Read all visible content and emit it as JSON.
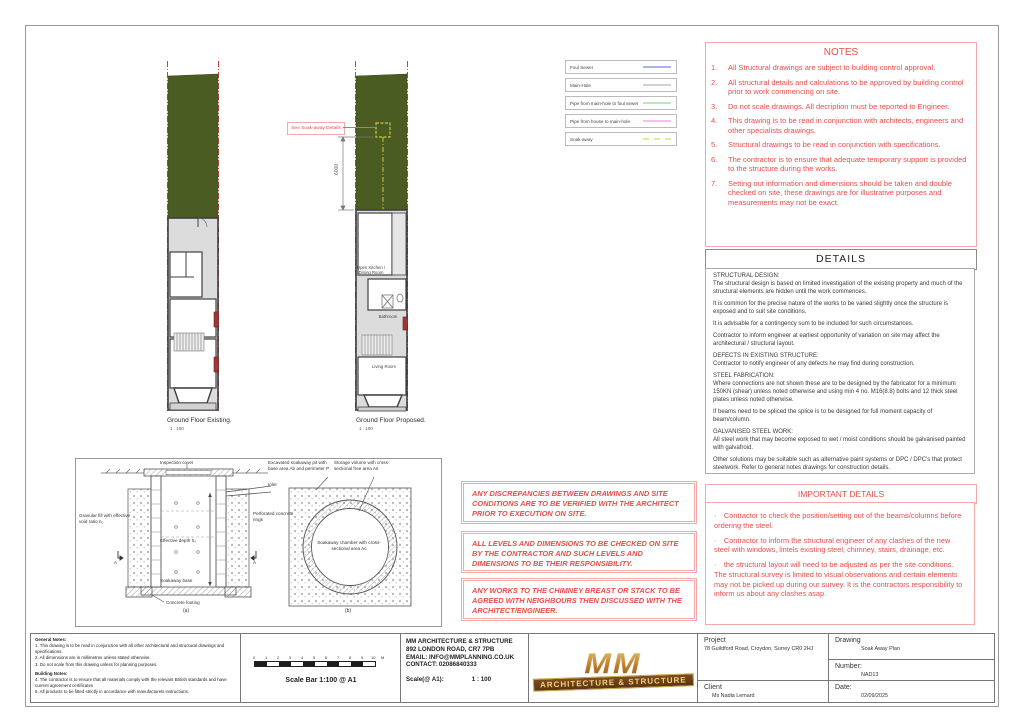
{
  "plans": {
    "existing": {
      "title": "Ground Floor Existing.",
      "scale": "1 : 100"
    },
    "proposed": {
      "title": "Ground Floor Proposed.",
      "scale": "1 : 100",
      "callout": "See Soak-away Details",
      "dimension": "6000",
      "rooms": {
        "kitchen": "Open Kitchen / Dining Room",
        "bathroom": "Bathroom",
        "living": "Living Room"
      }
    }
  },
  "legend": {
    "items": [
      {
        "label": "Foul Sewer",
        "color": "#a9b3ec",
        "line_style": "solid"
      },
      {
        "label": "Main-Hole",
        "color": "#d2d2d2",
        "line_style": "solid"
      },
      {
        "label": "Pipe from main-hole to foul sewer",
        "color": "#b4efb4",
        "line_style": "solid"
      },
      {
        "label": "Pipe from house to main-hole",
        "color": "#f6c0f2",
        "line_style": "solid"
      },
      {
        "label": "Soak-away",
        "color": "#e8e89a",
        "line_style": "dashed"
      }
    ]
  },
  "notes": {
    "title": "NOTES",
    "items": [
      {
        "num": "1.",
        "text": "All Structural drawings are subject to building control approval."
      },
      {
        "num": "2.",
        "text": "All structural details and calculations to be approved by building control prior to work commencing on site."
      },
      {
        "num": "3.",
        "text": "Do not scale drawings. All decription must be reported to Engineer."
      },
      {
        "num": "4.",
        "text": "This drawing is to be read in conjunction with architects, engineers and other specialists drawings."
      },
      {
        "num": "5.",
        "text": "Structural drawings to be read in conjunction with specifications."
      },
      {
        "num": "6.",
        "text": "The contractor is to ensure that adequate temporary support is provided to the structure during the works."
      },
      {
        "num": "7.",
        "text": "Setting out information and dimensions should be taken and double checked on site, these drawings are for illustrative purposes and measurements may not be exact."
      }
    ]
  },
  "details": {
    "title": "DETAILS",
    "paragraphs": [
      "STRUCTURAL DESIGN:\nThe structural design is based on limited investigation of the existing property and much of the structural elements are hidden until the work commences.",
      "It is common for the precise nature of the works to be varied slightly once the structure is exposed and to suit site conditions.",
      "It is advisable for a contingency sum to be included for such circumstances.",
      "Contractor to inform engineer at earliest opportunity of variation on site may affect the architectural / structural layout.",
      "DEFECTS IN EXISTING STRUCTURE:\nContractor to notify engineer of any defects he may find during construction.",
      "STEEL FABRICATION:\nWhere connections are not shown these are to be designed by the fabricator for a minimum 150KN (shear) unless noted otherwise and using min 4 no. M16(8.8) bolts and 12 thick steel plates unless noted otherwise.",
      "If beams need to be spliced the splice is to be designed for full moment capacity of beam/column.",
      "GALVANISED STEEL WORK:\nAll steel work that may become exposed to wet / moist conditions should be galvanised painted with galvafroid.",
      "Other solutions may be suitable such as alternative paint systems or DPC / DPC's that protect steelwork. Refer to general notes drawings for construction details."
    ]
  },
  "important": {
    "title": "IMPORTANT DETAILS",
    "bullets": [
      "· Contractor to check the position/setting out of the beams/columns before ordering the steel.",
      "· Contractor to inform the structural engineer of any clashes of the new steel with windows, lintels existing steel, chimney, stairs, drainage, etc.",
      "· the structural layout will need to be adjusted as per the site conditions. The structural survey is limited to visual observations and certain elements may not be picked up during our survey. It is the contractors responsibility to inform us about any clashes asap."
    ]
  },
  "warnings": [
    "ANY DISCREPANCIES BETWEEN DRAWINGS AND SITE CONDITIONS ARE TO BE VERIFIED WITH THE ARCHITECT PRIOR TO EXECUTION ON SITE.",
    "ALL LEVELS AND DIMENSIONS TO BE CHECKED ON SITE BY THE CONTRACTOR AND SUCH LEVELS AND DIMENSIONS TO BE THEIR RESPONSIBILITY.",
    "ANY WORKS TO THE CHIMNEY BREAST OR STACK TO BE AGREED WITH NEIGHBOURS THEN DISCUSSED WITH THE ARCHITECT/ENGINEER."
  ],
  "soakaway": {
    "a": {
      "inspection_cover": "Inspection cover",
      "inlet": "Inlet",
      "granular_fill": "Granular fill with effective void ratio n₀",
      "perforated_rings": "Perforated concrete rings",
      "effective_depth": "Effective depth h₀",
      "base": "Soakaway base",
      "footing": "Concrete footing",
      "section_marker": "A",
      "caption": "(a)"
    },
    "b": {
      "pit": "Excavated soakaway pit with base area Ab and perimeter P",
      "storage": "Storage volume with cross-sectional free area As",
      "chamber": "Soakaway chamber with cross-sectional area Ac",
      "caption": "(b)"
    }
  },
  "titleblock": {
    "general_notes_title": "General Notes:",
    "general_notes": [
      "1. This drawing is to be read in conjunction with all other architectural and structural drawings and specifications.",
      "2. All dimensions are in millimetres unless stated otherwise.",
      "3. Do not scale from this drawing unless for planning purposes."
    ],
    "building_notes_title": "Building Notes:",
    "building_notes": [
      "4. The contractor is to ensure that all materials comply with the relevant British standards and have current agreement certificates",
      "5. All products to be fitted strictly in accordance with manufacturels instructions."
    ],
    "scalebar_ticks": [
      "0",
      "1",
      "2",
      "3",
      "4",
      "5",
      "6",
      "7",
      "8",
      "9",
      "10",
      "M"
    ],
    "scalebar_label": "Scale Bar 1:100 @ A1",
    "firm": {
      "name": "MM ARCHITECTURE & STRUCTURE",
      "address": "892 LONDON ROAD, CR7 7PB",
      "email": "EMAIL: INFO@MMPLANNING.CO.UK",
      "contact": "CONTACT: 02086840333",
      "scale_label": "Scale(@ A1):",
      "scale_value": "1 : 100"
    },
    "logo": {
      "mm": "MM",
      "banner": "ARCHITECTURE & STRUCTURE"
    },
    "project_label": "Project",
    "project_value": "78 Guildford Road, Croydon, Surrey CR0 2HJ",
    "client_label": "Client",
    "client_value": "Ms Nadia Lemard",
    "drawing_label": "Drawing",
    "drawing_value": "Soak Away Plan",
    "number_label": "Number:",
    "number_value": "NAD13",
    "date_label": "Date:",
    "date_value": "02/09/2025"
  }
}
